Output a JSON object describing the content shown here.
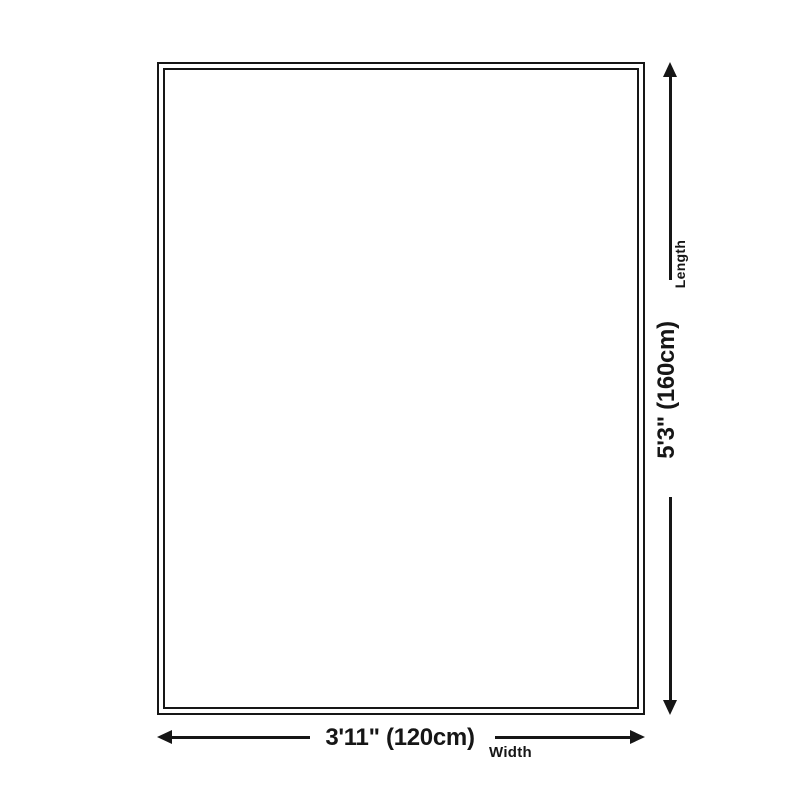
{
  "colors": {
    "ink": "#161616",
    "background": "#ffffff"
  },
  "diagram": {
    "length": {
      "value": "5'3\" (160cm)",
      "label": "Length"
    },
    "width": {
      "value": "3'11\" (120cm)",
      "label": "Width"
    }
  }
}
